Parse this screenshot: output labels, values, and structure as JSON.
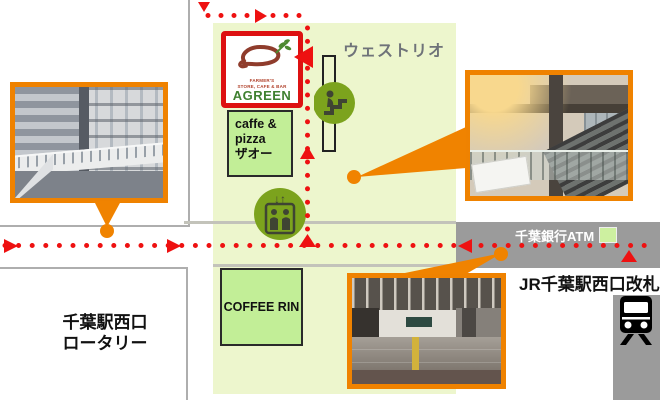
{
  "map": {
    "building_label": "ウェストリオ",
    "agreen": {
      "farm_line": "FARMER'S",
      "store_line": "STORE, CAFE & BAR",
      "name": "AGREEN"
    },
    "zao": {
      "line1": "caffe &",
      "line2": "pizza",
      "line3": "ザオー"
    },
    "coffee": {
      "label": "COFFEE RIN"
    }
  },
  "labels": {
    "atm": "千葉銀行ATM",
    "jr_gate": "JR千葉駅西口改札",
    "rotary_line1": "千葉駅西口",
    "rotary_line2": "ロータリー"
  },
  "icons": {
    "escalator": "escalator-icon",
    "elevator": "elevator-icon",
    "train": "train-icon",
    "elevator_arrows": "↓↑"
  },
  "colors": {
    "route_red": "#EE1111",
    "accent_orange": "#F08300",
    "map_green": "#EDF6CD",
    "shop_green": "#C2EE97",
    "street_gray": "#9B9B9B",
    "icon_green": "#7CA31D",
    "agreen_border_red": "#DD1111",
    "agreen_name_green": "#3F8030"
  },
  "photos": [
    {
      "name": "west-deck-photo"
    },
    {
      "name": "station-atrium-photo"
    },
    {
      "name": "west-gate-concourse-photo"
    }
  ]
}
